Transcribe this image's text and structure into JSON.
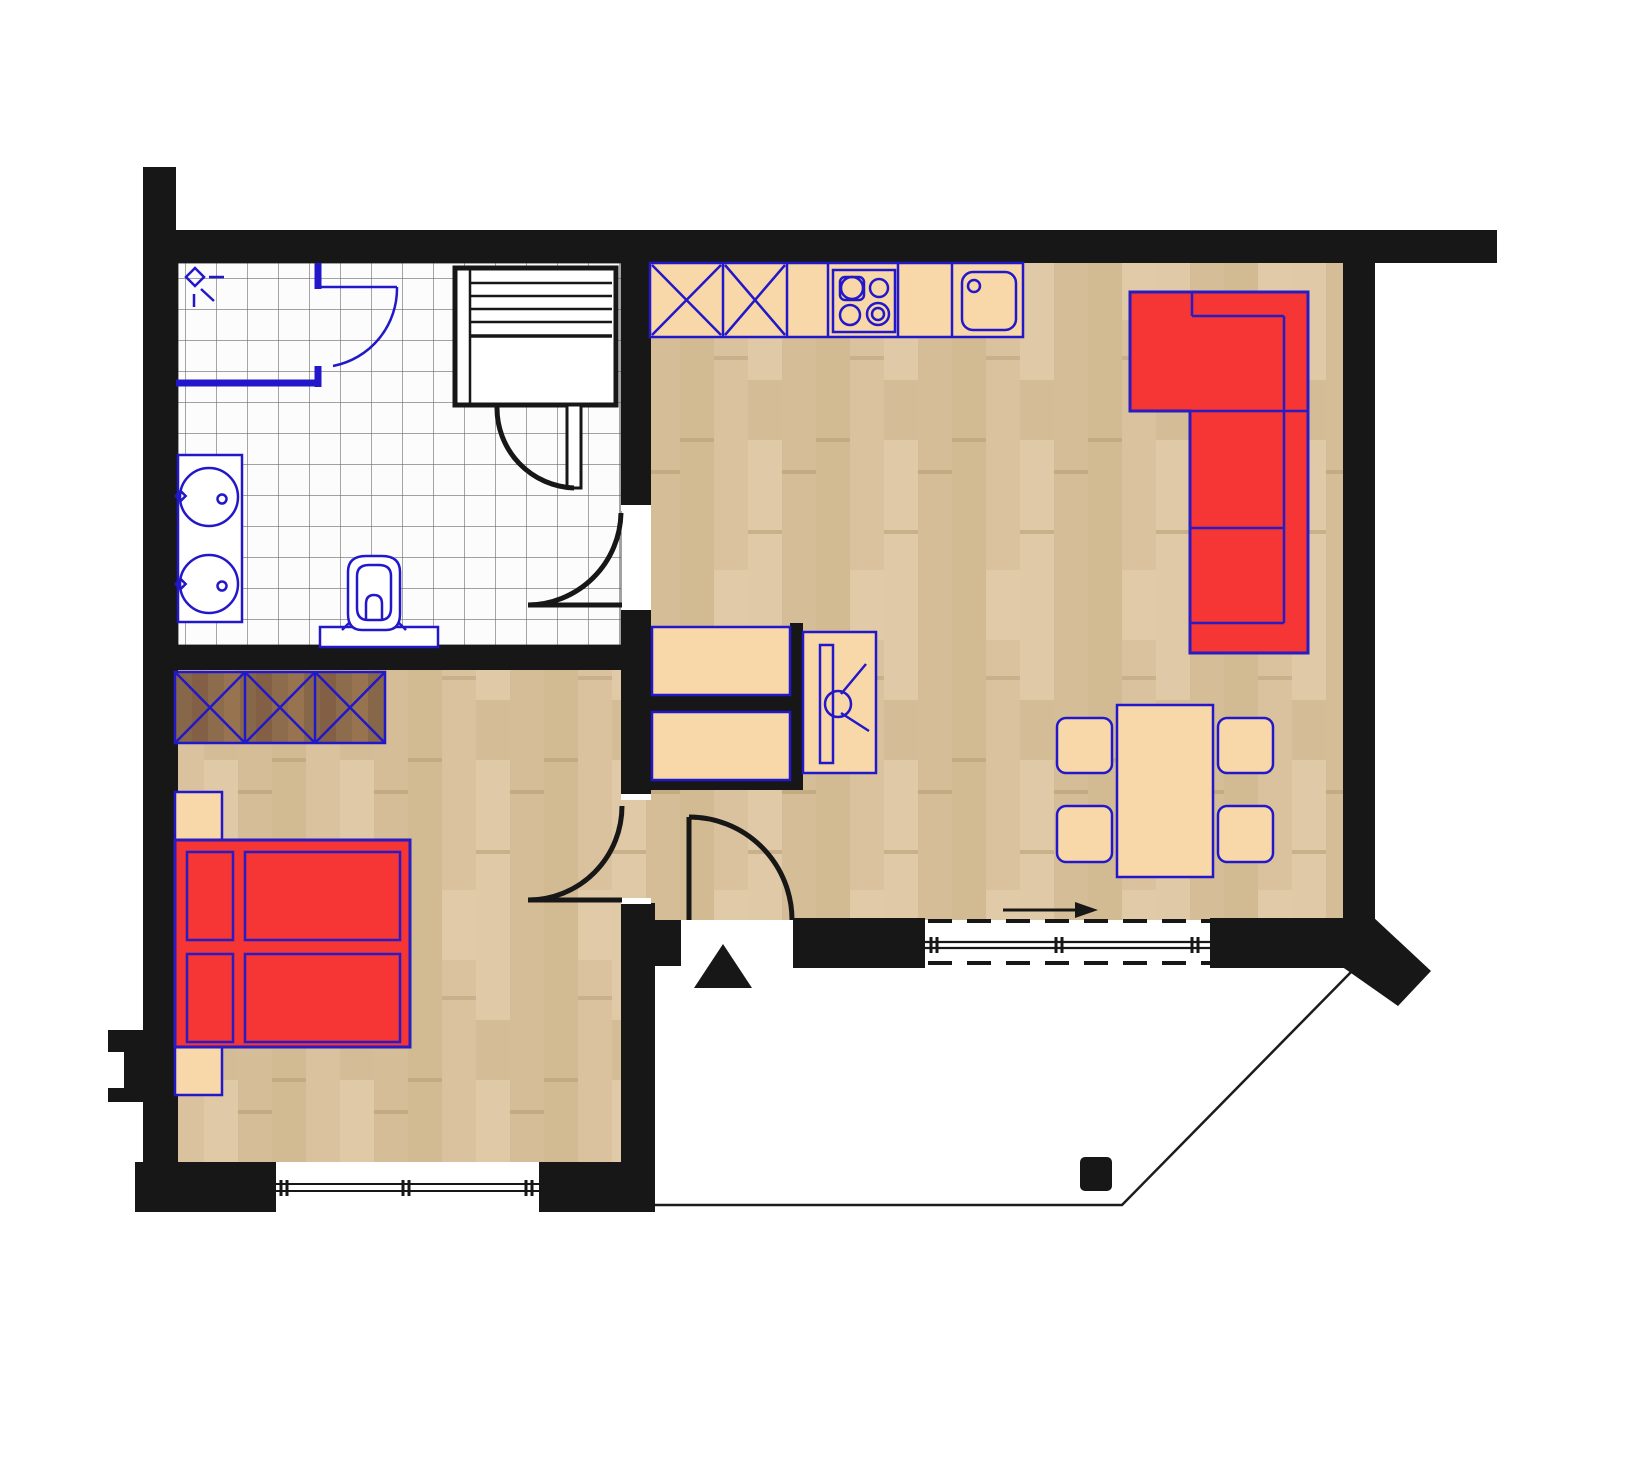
{
  "title": "apartment-floor-plan",
  "colors": {
    "wall": "#171717",
    "blue": "#2318c9",
    "tan": "#f8d8a8",
    "red": "#f63535",
    "tile": "#fcfcfc",
    "white": "#ffffff"
  },
  "plan": {
    "type": "apartment floor plan, top view, no text labels",
    "rooms": [
      {
        "id": "bathroom",
        "position": "top-left",
        "floor": "white square tile grid",
        "fixtures": [
          "corner shower with curved blue door and shower-head symbol",
          "sauna bench cabin with slatted top and swing door",
          "washbasin counter with two round basins",
          "toilet with cistern against dividing wall"
        ]
      },
      {
        "id": "bedroom",
        "position": "bottom-left",
        "floor": "light wood planks",
        "furniture": [
          "triple wardrobe with X-front sections (dark wood)",
          "red double bed with two pillows and two mattresses",
          "two bedside cabinets"
        ],
        "window": "triple-pane window in bottom exterior wall"
      },
      {
        "id": "living-kitchen",
        "position": "right",
        "floor": "light wood planks",
        "furniture": [
          "kitchen counter: two X-front cabinets, worktop, 4-burner hob, worktop, sink",
          "red L-shaped corner sofa along top-right walls",
          "dining table with four chairs",
          "two hall cabinets with black partitions",
          "tv sideboard with swivel symbol"
        ]
      },
      {
        "id": "terrace",
        "position": "bottom-right",
        "floor": "white, outlined with thin boundary line at 45°",
        "features": [
          "small black post",
          "black entrance triangle marker"
        ]
      }
    ],
    "doors": [
      {
        "id": "shower-door",
        "style": "blue quarter-arc",
        "room": "bathroom"
      },
      {
        "id": "sauna-door",
        "style": "black quarter-arc with white leaf",
        "room": "bathroom"
      },
      {
        "id": "bathroom-door",
        "style": "black quarter-arc, opens into bathroom",
        "wall": "bathroom / hall"
      },
      {
        "id": "bedroom-door",
        "style": "black quarter-arc, opens into bedroom",
        "wall": "bedroom / hall"
      },
      {
        "id": "entrance-door",
        "style": "black quarter-arc, opens inward from terrace",
        "wall": "living room bottom"
      }
    ],
    "windows": [
      {
        "id": "bedroom-window",
        "style": "triple-pane, bottom wall"
      },
      {
        "id": "sliding-terrace-door",
        "style": "glass slider with dashed track lines and direction arrow pointing right"
      }
    ]
  }
}
